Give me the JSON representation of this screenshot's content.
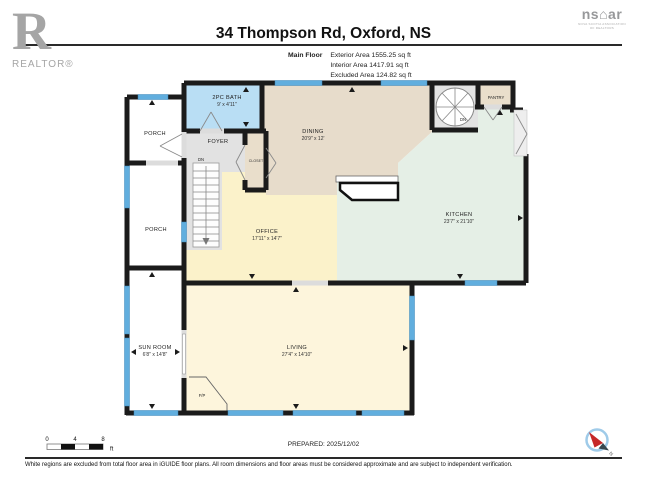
{
  "header": {
    "title": "34 Thompson Rd, Oxford, NS",
    "floor_label": "Main Floor",
    "area_lines": [
      "Exterior Area 1555.25 sq ft",
      "Interior Area 1417.91 sq ft",
      "Excluded Area 124.82 sq ft"
    ],
    "realtor": {
      "letter": "R",
      "label": "REALTOR®"
    },
    "nsar": {
      "left": "ns",
      "roof": "⌂",
      "right": "ar",
      "caption_line1": "NOVA SCOTIA ASSOCIATION",
      "caption_line2": "OF REALTORS"
    }
  },
  "plan": {
    "rooms": [
      {
        "name": "2PC BATH",
        "dims": "9' x 4'11\""
      },
      {
        "name": "FOYER",
        "dims": ""
      },
      {
        "name": "CLOSET",
        "dims": ""
      },
      {
        "name": "DINING",
        "dims": "20'9\" x 12'"
      },
      {
        "name": "PANTRY",
        "dims": ""
      },
      {
        "name": "KITCHEN",
        "dims": "23'7\" x 21'10\""
      },
      {
        "name": "OFFICE",
        "dims": "17'11\" x 14'7\""
      },
      {
        "name": "PORCH",
        "dims": ""
      },
      {
        "name": "PORCH",
        "dims": ""
      },
      {
        "name": "SUN ROOM",
        "dims": "6'8\" x 14'8\""
      },
      {
        "name": "LIVING",
        "dims": "27'4\" x 14'10\""
      },
      {
        "name": "F/P",
        "dims": ""
      },
      {
        "name": "DN",
        "dims": ""
      },
      {
        "name": "DN",
        "dims": ""
      }
    ],
    "colors": {
      "wall": "#1b1b1b",
      "window": "#61aede",
      "door_gap": "#dcdcdc",
      "bath": "#b9def4",
      "foyer": "#e2e2e2",
      "closet": "#e9decb",
      "dining": "#e7dccb",
      "pantry": "#e9decb",
      "kitchen": "#e5efe6",
      "office": "#fbf2ca",
      "living": "#fdf5dc",
      "excluded": "#ffffff",
      "realtor_gray": "#a5a5a5",
      "nsar_gray": "#97989a",
      "compass_red": "#c62828",
      "compass_ring": "#9fcbe9"
    }
  },
  "footer": {
    "scale": {
      "t0": "0",
      "t1": "4",
      "t2": "8",
      "unit": "ft"
    },
    "prepared": "PREPARED: 2025/12/02",
    "compass_label": "N",
    "disclaimer": "White regions are excluded from total floor area in iGUIDE floor plans. All room dimensions and floor areas must be considered approximate and are subject to independent verification."
  }
}
